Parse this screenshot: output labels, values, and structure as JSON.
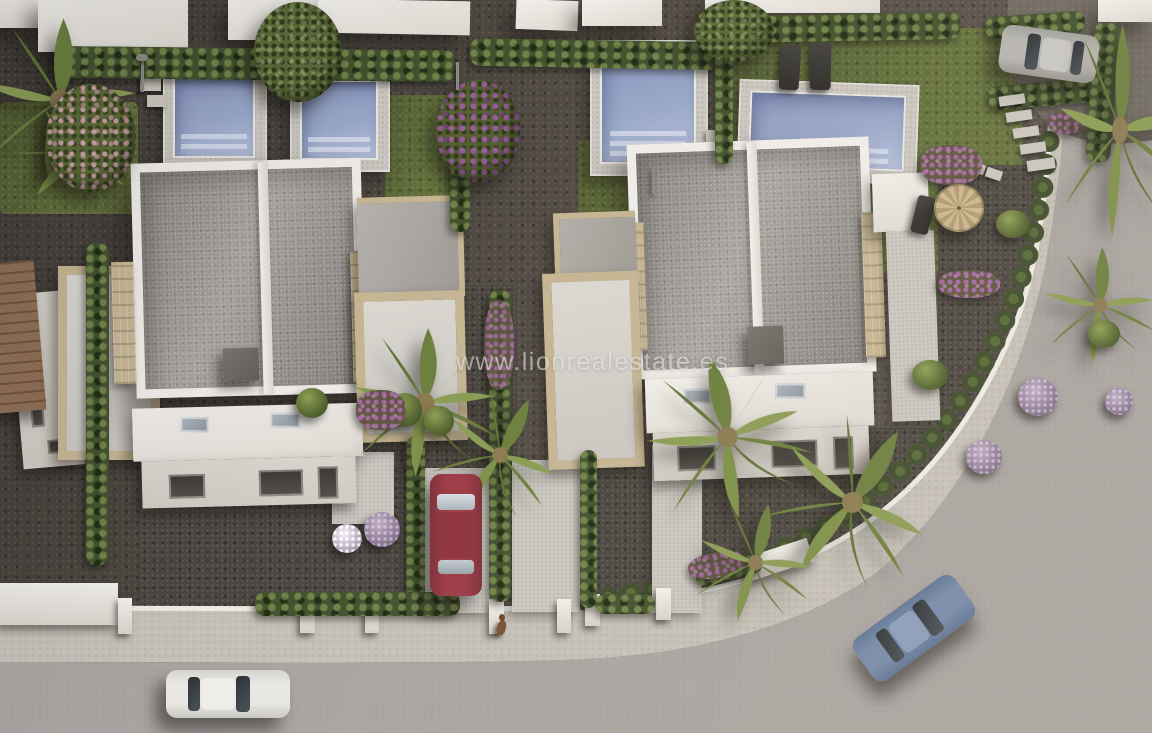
{
  "watermark": {
    "text": "www.lionrealestate.es"
  },
  "palette": {
    "ground": "#564f48",
    "gravel_dark": "#4a453f",
    "lawn": "#64713d",
    "hedge": "#42512e",
    "pool_water": "#8795bb",
    "pool_water_light": "#b6c1dc",
    "pool_deck": "#cbc7c0",
    "villa_white": "#efece7",
    "roof_gravel": "#a7a39e",
    "stone_trim": "#c6b593",
    "chimney_gray": "#6e6a66",
    "road_asphalt": "#a9a4a1",
    "sidewalk": "#c4bfb7",
    "curb_white": "#eceae4",
    "drive_gravel": "#6f6961",
    "car_white": "#e9e7e2",
    "car_red": "#9c3b46",
    "car_blue": "#7589aa",
    "car_silver": "#b6b4b0",
    "palm_green": "#6c7f3e",
    "palm_light": "#8a9c54",
    "flower_purple": "#8d5f93",
    "tile_roof": "#85644a"
  }
}
